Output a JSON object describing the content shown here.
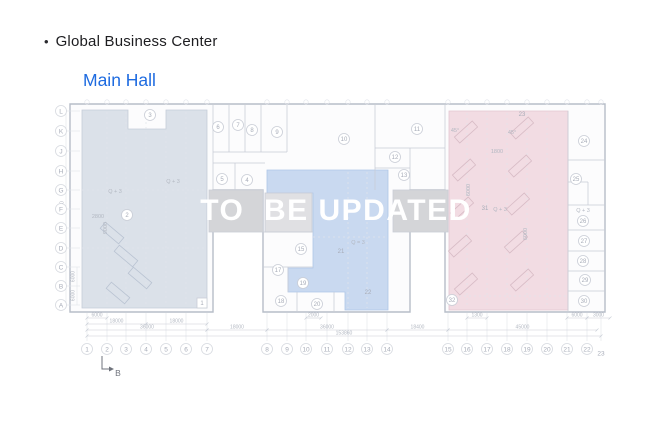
{
  "slide": {
    "bullet": "•",
    "title": "Global Business Center",
    "subtitle": "Main Hall",
    "watermark": "TO  BE UPDATED"
  },
  "colors": {
    "title": "#1d1d20",
    "subtitle": "#1e6be0",
    "watermark": "#ffffff",
    "plan_bg": "#fcfcfd",
    "wall": "#b7bdc8",
    "line": "#c9cdd6",
    "faint": "#e1e4ea",
    "label": "#a7acb8",
    "dim_text": "#b3b8c2",
    "zone_left": "#dbe1e9",
    "zone_middle": "#c9d9f0",
    "zone_right": "#f2dce3",
    "gray_room": "#d4d5d8",
    "gray_room_light": "#e0e0e3",
    "desk_left": "#b9c3d2",
    "desk_right": "#d8bcc6",
    "marker": "#6f737c"
  },
  "axes": {
    "rows": [
      {
        "label": "L",
        "y": 111
      },
      {
        "label": "K",
        "y": 131
      },
      {
        "label": "J",
        "y": 151
      },
      {
        "label": "H",
        "y": 171
      },
      {
        "label": "G",
        "y": 190
      },
      {
        "label": "F",
        "y": 209
      },
      {
        "label": "E",
        "y": 228
      },
      {
        "label": "D",
        "y": 248
      },
      {
        "label": "C",
        "y": 267
      },
      {
        "label": "B",
        "y": 286
      },
      {
        "label": "A",
        "y": 305
      }
    ],
    "cols": [
      {
        "label": "1",
        "x": 87
      },
      {
        "label": "2",
        "x": 107
      },
      {
        "label": "3",
        "x": 126
      },
      {
        "label": "4",
        "x": 146
      },
      {
        "label": "5",
        "x": 166
      },
      {
        "label": "6",
        "x": 186
      },
      {
        "label": "7",
        "x": 207
      },
      {
        "label": "8",
        "x": 267
      },
      {
        "label": "9",
        "x": 287
      },
      {
        "label": "10",
        "x": 306
      },
      {
        "label": "11",
        "x": 327
      },
      {
        "label": "12",
        "x": 348
      },
      {
        "label": "13",
        "x": 367
      },
      {
        "label": "14",
        "x": 387
      },
      {
        "label": "15",
        "x": 448
      },
      {
        "label": "16",
        "x": 467
      },
      {
        "label": "17",
        "x": 487
      },
      {
        "label": "18",
        "x": 507
      },
      {
        "label": "19",
        "x": 527
      },
      {
        "label": "20",
        "x": 547
      },
      {
        "label": "21",
        "x": 567
      },
      {
        "label": "22",
        "x": 587
      },
      {
        "label": "23",
        "x": 601,
        "plain": true
      }
    ]
  },
  "rooms": [
    {
      "n": "1",
      "x": 202,
      "y": 303,
      "style": "square"
    },
    {
      "n": "2",
      "x": 127,
      "y": 215
    },
    {
      "n": "3",
      "x": 150,
      "y": 115
    },
    {
      "n": "4",
      "x": 247,
      "y": 180
    },
    {
      "n": "5",
      "x": 222,
      "y": 179
    },
    {
      "n": "6",
      "x": 218,
      "y": 127
    },
    {
      "n": "7",
      "x": 238,
      "y": 125
    },
    {
      "n": "8",
      "x": 252,
      "y": 130
    },
    {
      "n": "9",
      "x": 277,
      "y": 132
    },
    {
      "n": "10",
      "x": 344,
      "y": 139
    },
    {
      "n": "11",
      "x": 417,
      "y": 129
    },
    {
      "n": "12",
      "x": 395,
      "y": 157
    },
    {
      "n": "13",
      "x": 404,
      "y": 175
    },
    {
      "n": "15",
      "x": 301,
      "y": 249
    },
    {
      "n": "17",
      "x": 278,
      "y": 270
    },
    {
      "n": "18",
      "x": 281,
      "y": 301
    },
    {
      "n": "19",
      "x": 303,
      "y": 283
    },
    {
      "n": "20",
      "x": 317,
      "y": 304
    },
    {
      "n": "21",
      "x": 341,
      "y": 251,
      "style": "plain"
    },
    {
      "n": "22",
      "x": 368,
      "y": 292,
      "style": "plain"
    },
    {
      "n": "23",
      "x": 522,
      "y": 114,
      "style": "plain"
    },
    {
      "n": "24",
      "x": 584,
      "y": 141
    },
    {
      "n": "25",
      "x": 576,
      "y": 179
    },
    {
      "n": "26",
      "x": 583,
      "y": 221
    },
    {
      "n": "27",
      "x": 584,
      "y": 241
    },
    {
      "n": "28",
      "x": 583,
      "y": 261
    },
    {
      "n": "29",
      "x": 585,
      "y": 280
    },
    {
      "n": "30",
      "x": 584,
      "y": 301
    },
    {
      "n": "31",
      "x": 485,
      "y": 208,
      "style": "plain"
    },
    {
      "n": "32",
      "x": 452,
      "y": 300
    }
  ],
  "texts": [
    {
      "t": "Q + 3",
      "x": 115,
      "y": 193
    },
    {
      "t": "Q + 3",
      "x": 173,
      "y": 183
    },
    {
      "t": "Q = 3",
      "x": 358,
      "y": 244
    },
    {
      "t": "Q + 3",
      "x": 500,
      "y": 211
    },
    {
      "t": "Q + 3",
      "x": 583,
      "y": 212
    },
    {
      "t": "2800",
      "x": 98,
      "y": 218
    },
    {
      "t": "1800",
      "x": 497,
      "y": 153
    },
    {
      "t": "45°",
      "x": 455,
      "y": 132
    },
    {
      "t": "45°",
      "x": 512,
      "y": 134
    },
    {
      "t": "9000",
      "x": 107,
      "y": 228,
      "rot": 1
    },
    {
      "t": "6000",
      "x": 470,
      "y": 190,
      "rot": 1
    },
    {
      "t": "6000",
      "x": 527,
      "y": 234,
      "rot": 1
    }
  ],
  "dims_bottom": [
    {
      "t": "6000",
      "x1": 87,
      "x2": 107,
      "y": 318
    },
    {
      "t": "2000",
      "x1": 306,
      "x2": 321,
      "y": 318
    },
    {
      "t": "1300",
      "x1": 467,
      "x2": 487,
      "y": 318
    },
    {
      "t": "6000",
      "x1": 567,
      "x2": 587,
      "y": 318
    },
    {
      "t": "3000",
      "x1": 587,
      "x2": 610,
      "y": 318
    },
    {
      "t": "18000",
      "x1": 87,
      "x2": 146,
      "y": 324
    },
    {
      "t": "18000",
      "x1": 146,
      "x2": 207,
      "y": 324
    },
    {
      "t": "36000",
      "x1": 87,
      "x2": 207,
      "y": 330
    },
    {
      "t": "18000",
      "x1": 207,
      "x2": 267,
      "y": 330
    },
    {
      "t": "36000",
      "x1": 267,
      "x2": 387,
      "y": 330
    },
    {
      "t": "18400",
      "x1": 387,
      "x2": 448,
      "y": 330
    },
    {
      "t": "45000",
      "x1": 448,
      "x2": 597,
      "y": 330
    },
    {
      "t": "153860",
      "x1": 87,
      "x2": 601,
      "y": 336
    }
  ],
  "dims_left": [
    {
      "t": "60000",
      "x": 66,
      "y1": 111,
      "y2": 305
    },
    {
      "t": "6000",
      "x": 77,
      "y1": 267,
      "y2": 286
    },
    {
      "t": "6000",
      "x": 77,
      "y1": 286,
      "y2": 305
    }
  ],
  "section_marker": {
    "label": "B"
  },
  "geometry": {
    "outline": [
      [
        70,
        104
      ],
      [
        605,
        104
      ],
      [
        605,
        312
      ],
      [
        445,
        312
      ],
      [
        445,
        190
      ],
      [
        410,
        190
      ],
      [
        410,
        312
      ],
      [
        263,
        312
      ],
      [
        263,
        190
      ],
      [
        213,
        190
      ],
      [
        213,
        312
      ],
      [
        70,
        312
      ]
    ],
    "zones": [
      {
        "name": "zone-left",
        "fill": "zone_left",
        "border": "#c5cdd9",
        "points": [
          [
            82,
            110
          ],
          [
            128,
            110
          ],
          [
            128,
            129
          ],
          [
            166,
            129
          ],
          [
            166,
            110
          ],
          [
            207,
            110
          ],
          [
            207,
            308
          ],
          [
            82,
            308
          ]
        ]
      },
      {
        "name": "zone-middle",
        "fill": "zone_middle",
        "border": "#aec6e8",
        "points": [
          [
            267,
            170
          ],
          [
            388,
            170
          ],
          [
            388,
            310
          ],
          [
            345,
            310
          ],
          [
            345,
            292
          ],
          [
            288,
            292
          ],
          [
            288,
            268
          ],
          [
            313,
            268
          ],
          [
            313,
            193
          ],
          [
            267,
            193
          ]
        ]
      },
      {
        "name": "zone-right",
        "fill": "zone_right",
        "border": "#e4c6d0",
        "points": [
          [
            449,
            111
          ],
          [
            568,
            111
          ],
          [
            568,
            310
          ],
          [
            449,
            310
          ]
        ]
      }
    ],
    "gray_rooms": [
      {
        "x": 209,
        "y": 190,
        "w": 54,
        "h": 42,
        "fill": "gray_room"
      },
      {
        "x": 393,
        "y": 190,
        "w": 55,
        "h": 42,
        "fill": "gray_room"
      },
      {
        "x": 265,
        "y": 193,
        "w": 47,
        "h": 39,
        "fill": "gray_room_light"
      }
    ],
    "walls": [
      [
        213,
        104,
        213,
        190
      ],
      [
        445,
        104,
        445,
        190
      ],
      [
        213,
        152,
        287,
        152
      ],
      [
        229,
        104,
        229,
        152
      ],
      [
        245,
        104,
        245,
        152
      ],
      [
        261,
        104,
        261,
        152
      ],
      [
        287,
        104,
        287,
        152
      ],
      [
        213,
        163,
        265,
        163
      ],
      [
        235,
        163,
        235,
        190
      ],
      [
        375,
        104,
        375,
        190
      ],
      [
        375,
        148,
        445,
        148
      ],
      [
        410,
        148,
        410,
        190
      ],
      [
        375,
        168,
        410,
        168
      ],
      [
        568,
        111,
        568,
        312
      ],
      [
        568,
        160,
        605,
        160
      ],
      [
        568,
        205,
        605,
        205
      ],
      [
        568,
        230,
        605,
        230
      ],
      [
        568,
        251,
        605,
        251
      ],
      [
        568,
        271,
        605,
        271
      ],
      [
        568,
        291,
        605,
        291
      ],
      [
        588,
        182,
        588,
        205
      ],
      [
        568,
        182,
        588,
        182
      ],
      [
        263,
        232,
        313,
        232
      ],
      [
        263,
        267,
        313,
        267
      ],
      [
        288,
        267,
        288,
        292
      ],
      [
        297,
        292,
        297,
        312
      ],
      [
        334,
        292,
        334,
        312
      ]
    ],
    "dashes": [
      [
        107,
        112,
        107,
        306
      ],
      [
        126,
        112,
        126,
        306
      ],
      [
        146,
        112,
        146,
        306
      ],
      [
        166,
        131,
        166,
        306
      ],
      [
        186,
        112,
        186,
        306
      ],
      [
        348,
        172,
        348,
        308
      ],
      [
        367,
        172,
        367,
        308
      ],
      [
        313,
        237,
        388,
        237
      ],
      [
        467,
        113,
        467,
        308
      ],
      [
        487,
        113,
        487,
        308
      ],
      [
        507,
        113,
        507,
        308
      ],
      [
        527,
        113,
        527,
        308
      ],
      [
        547,
        113,
        547,
        308
      ],
      [
        449,
        296,
        568,
        296
      ],
      [
        82,
        190,
        207,
        190
      ],
      [
        82,
        248,
        207,
        248
      ]
    ],
    "desks_right": [
      [
        466,
        132
      ],
      [
        464,
        170
      ],
      [
        462,
        208
      ],
      [
        460,
        246
      ],
      [
        466,
        284
      ],
      [
        522,
        128
      ],
      [
        520,
        166
      ],
      [
        518,
        204
      ],
      [
        516,
        242
      ],
      [
        522,
        280
      ]
    ],
    "desks_left": [
      [
        112,
        233
      ],
      [
        126,
        256
      ],
      [
        140,
        278
      ],
      [
        118,
        293
      ]
    ]
  }
}
